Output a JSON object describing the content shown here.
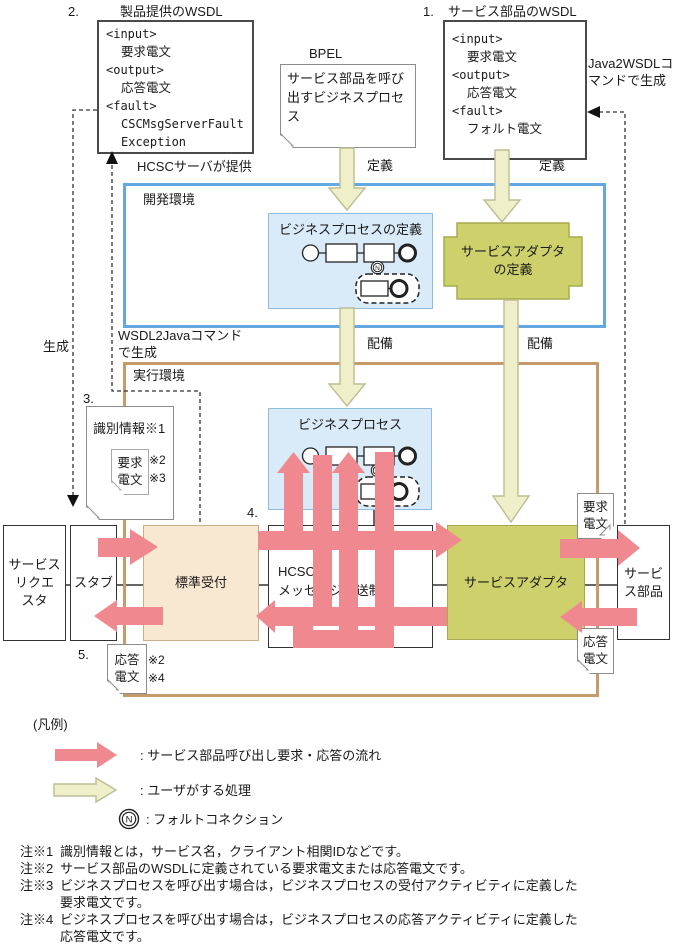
{
  "labels": {
    "num2": "2.",
    "wsdl_product_title": "製品提供のWSDL",
    "num1": "1.",
    "wsdl_service_title": "サービス部品のWSDL",
    "bpel": "BPEL",
    "bpel_note": "サービス部品を呼び\n出すビジネスプロセ\nス",
    "java2wsdl": "Java2WSDLコ\nマンドで生成",
    "hcsc_provided": "HCSCサーバが提供",
    "define_left": "定義",
    "define_right": "定義",
    "generate": "生成",
    "wsdl2java": "WSDL2Javaコマンド\nで生成",
    "deploy_left": "配備",
    "deploy_right": "配備",
    "num3": "3.",
    "num4": "4.",
    "num5": "5."
  },
  "wsdl_left": {
    "l1": "<input>",
    "l2": "要求電文",
    "l3": "<output>",
    "l4": "応答電文",
    "l5": "<fault>",
    "l6": "CSCMsgServerFault",
    "l7": "Exception"
  },
  "wsdl_right": {
    "l1": "<input>",
    "l2": "要求電文",
    "l3": "<output>",
    "l4": "応答電文",
    "l5": "<fault>",
    "l6": "フォルト電文"
  },
  "env": {
    "dev": "開発環境",
    "runtime": "実行環境"
  },
  "nodes": {
    "bp_def": "ビジネスプロセスの定義",
    "adapter_def": "サービスアダプタ\nの定義",
    "bp": "ビジネスプロセス",
    "requester": "サービス\nリクエ\nスタ",
    "stub": "スタブ",
    "reception": "標準受付",
    "hcsc": "HCSC\nメッセージ配送制御",
    "adapter": "サービスアダプタ",
    "component": "サービ\nス部品"
  },
  "annotations": {
    "id_note": "識別情報※1",
    "req_small": "要求\n電文",
    "ref2a": "※2",
    "ref3": "※3",
    "resp_small": "応答\n電文",
    "ref2b": "※2",
    "ref4": "※4",
    "req_right": "要求\n電文",
    "resp_right": "応答\n電文"
  },
  "legend": {
    "title": "(凡例)",
    "flow": ": サービス部品呼び出し要求・応答の流れ",
    "user": ": ユーザがする処理",
    "fault": ": フォルトコネクション",
    "fault_glyph": "N"
  },
  "notes": [
    {
      "tag": "注※1",
      "text": "識別情報とは，サービス名，クライアント相関IDなどです。"
    },
    {
      "tag": "注※2",
      "text": "サービス部品のWSDLに定義されている要求電文または応答電文です。"
    },
    {
      "tag": "注※3",
      "text": "ビジネスプロセスを呼び出す場合は，ビジネスプロセスの受付アクティビティに定義した\n要求電文です。"
    },
    {
      "tag": "注※4",
      "text": "ビジネスプロセスを呼び出す場合は，ビジネスプロセスの応答アクティビティに定義した\n応答電文です。"
    }
  ],
  "colors": {
    "flow_arrow": "#F0898F",
    "user_arrow": "#EFEFC9",
    "user_arrow_border": "#BDBD93",
    "adapter_fill": "#CDD06B",
    "adapter_border": "#A7AA4E",
    "dev_border": "#64A8E2",
    "runtime_border": "#C79A6B",
    "bp_fill": "#D9EBF8",
    "reception_fill": "#F8E8D2"
  }
}
